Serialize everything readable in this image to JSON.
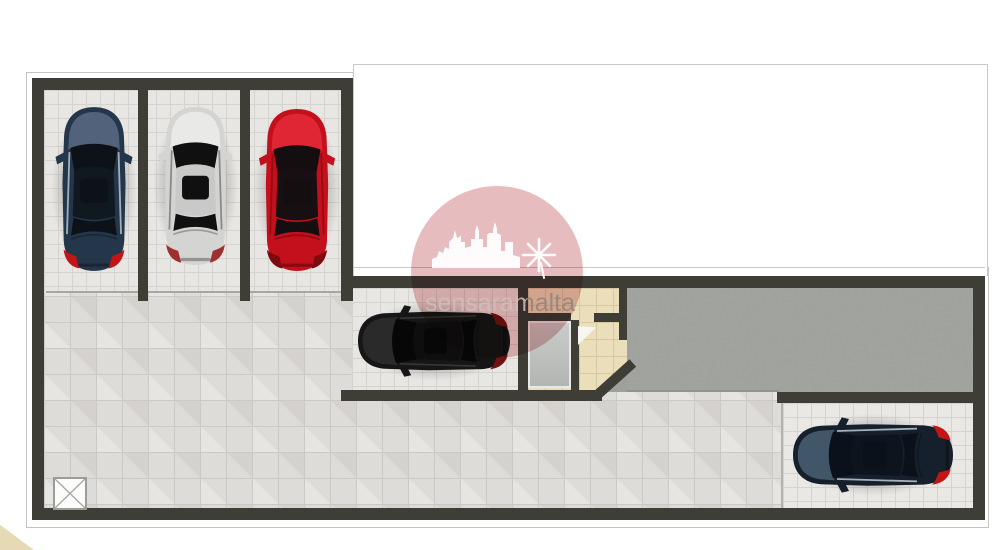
{
  "plan": {
    "type": "garage-basement-floor-plan",
    "watermark": {
      "text": "sensaramalta",
      "badge_color": "#c05a60",
      "castle_icon": "castle-skyline-icon",
      "windmill_icon": "windmill-icon"
    },
    "areas": [
      {
        "id": "bay-1",
        "kind": "parking-bay"
      },
      {
        "id": "bay-2",
        "kind": "parking-bay"
      },
      {
        "id": "bay-3",
        "kind": "parking-bay"
      },
      {
        "id": "bay-mid",
        "kind": "enclosed-garage-bay"
      },
      {
        "id": "bay-right",
        "kind": "parking-bay"
      },
      {
        "id": "driveway-ramp",
        "kind": "ramp"
      },
      {
        "id": "entrance-lobby",
        "kind": "lobby"
      },
      {
        "id": "open-floor",
        "kind": "manoeuvring-area"
      },
      {
        "id": "shaft-marker",
        "kind": "x-square-symbol"
      }
    ],
    "cars": [
      {
        "id": "navy-suv",
        "orientation": "nose-up",
        "cx": 94,
        "cy": 189,
        "w": 84,
        "h": 172,
        "rot": 0,
        "body": "#24364a",
        "hood": "#51627a",
        "glass": "#0c1218",
        "roof": "#101820",
        "rail": "#b9c4cf",
        "tail": "#c01616"
      },
      {
        "id": "silver-car",
        "orientation": "nose-up",
        "cx": 195,
        "cy": 186,
        "w": 83,
        "h": 166,
        "rot": 0,
        "body": "#d4d4d2",
        "hood": "#e9e9e7",
        "glass": "#101010",
        "roof": "#c9c9c7",
        "rail": "#7a7a78",
        "tail": "#a03030"
      },
      {
        "id": "red-sports",
        "orientation": "nose-up",
        "cx": 297,
        "cy": 190,
        "w": 86,
        "h": 170,
        "rot": 0,
        "body": "#c40f1c",
        "hood": "#e02535",
        "glass": "#150e10",
        "roof": "#170f12",
        "rail": "#8f0a14",
        "tail": "#7e0a10"
      },
      {
        "id": "black-wagon",
        "orientation": "nose-left",
        "cx": 434,
        "cy": 341,
        "w": 76,
        "h": 164,
        "rot": -90,
        "body": "#161616",
        "hood": "#2a2a2a",
        "glass": "#070707",
        "roof": "#0e0e0e",
        "rail": "#3c3c3c",
        "tail": "#701212"
      },
      {
        "id": "darkblue-suv",
        "orientation": "nose-left",
        "cx": 873,
        "cy": 455,
        "w": 80,
        "h": 168,
        "rot": -90,
        "body": "#16202c",
        "hood": "#42566a",
        "glass": "#0a111a",
        "roof": "#0d141d",
        "rail": "#c2cad2",
        "tail": "#c41414"
      }
    ],
    "palette": {
      "wall": "#3e3e36",
      "floor_tile": "#dedcd8",
      "bay_tile": "#e8e6e2",
      "ramp": "#9da09b",
      "lobby_tile": "#eadebb",
      "door_panel": "#c0c3c0",
      "outline": "#c5c4c0"
    }
  }
}
